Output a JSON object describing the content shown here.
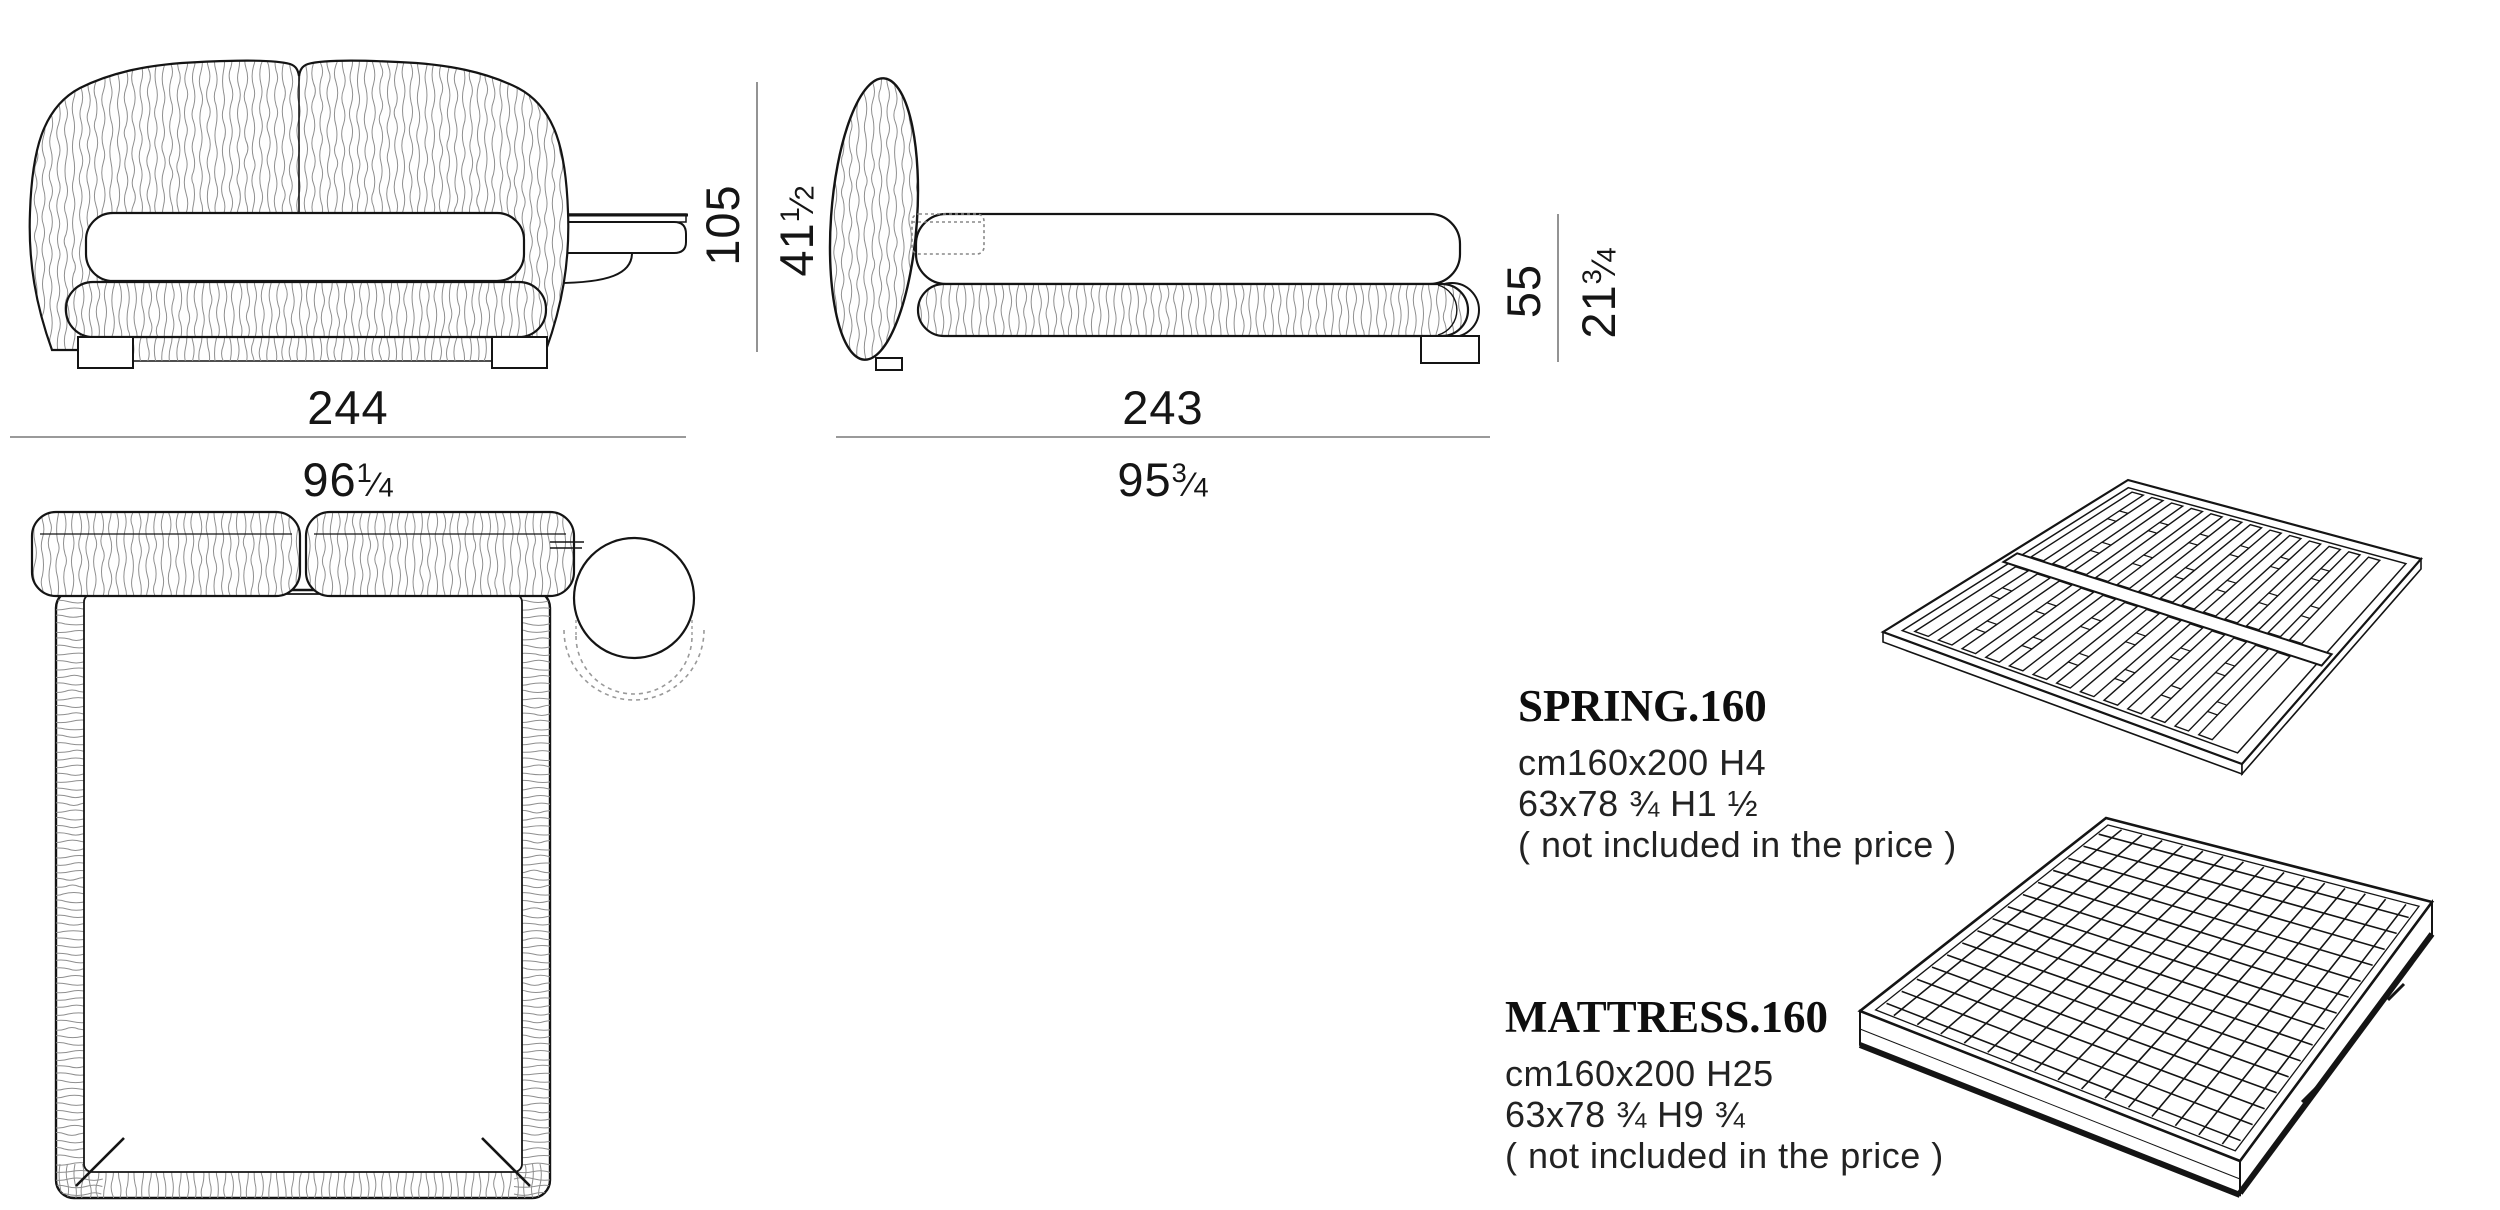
{
  "dimensions": {
    "front_width": {
      "cm": "244",
      "in_whole": "96",
      "in_num": "1",
      "in_den": "4"
    },
    "front_height": {
      "cm": "105",
      "in_whole": "41",
      "in_num": "1",
      "in_den": "2"
    },
    "side_length": {
      "cm": "243",
      "in_whole": "95",
      "in_num": "3",
      "in_den": "4"
    },
    "side_height": {
      "cm": "55",
      "in_whole": "21",
      "in_num": "3",
      "in_den": "4"
    }
  },
  "ui": {
    "fraction_slash": "⁄"
  },
  "products": [
    {
      "name": "SPRING.160",
      "size_cm": "cm160x200 H4",
      "size_in": "63x78 ¾ H1 ½",
      "note": "( not included in the price )"
    },
    {
      "name": "MATTRESS.160",
      "size_cm": "cm160x200 H25",
      "size_in": "63x78 ¾ H9 ¾",
      "note": "( not included in the price )"
    }
  ],
  "drawing_colors": {
    "line": "#141414",
    "texture": "#8f8f8f",
    "dim_line": "#787878"
  }
}
